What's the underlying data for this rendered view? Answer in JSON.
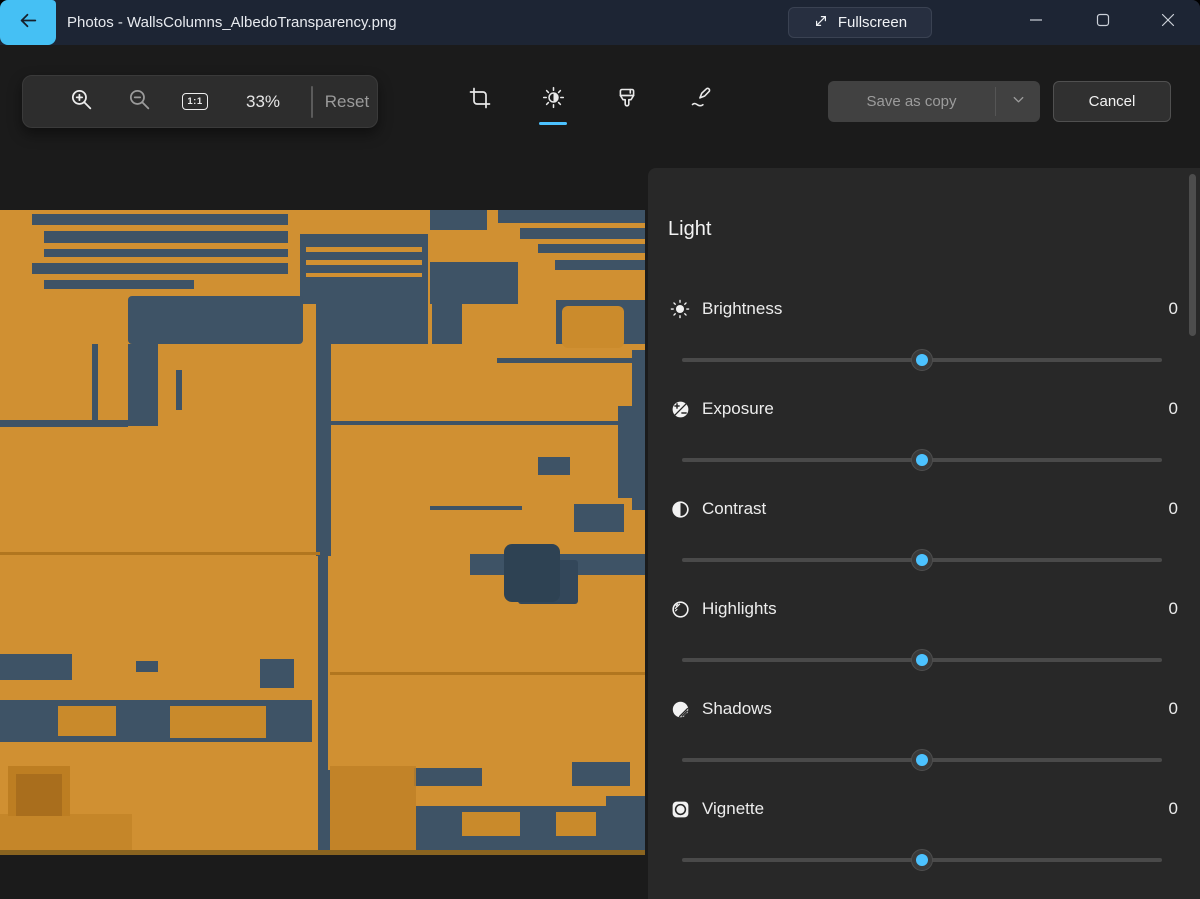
{
  "titlebar": {
    "title": "Photos - WallsColumns_AlbedoTransparency.png",
    "fullscreen_label": "Fullscreen"
  },
  "toolbar": {
    "zoom_level": "33%",
    "actual_size_label": "1:1",
    "reset_label": "Reset",
    "selected_tool": "light-adjustment",
    "save_label": "Save as copy",
    "cancel_label": "Cancel"
  },
  "panel": {
    "heading": "Light",
    "sliders": [
      {
        "label": "Brightness",
        "value": "0",
        "icon": "brightness",
        "position_pct": 50
      },
      {
        "label": "Exposure",
        "value": "0",
        "icon": "exposure",
        "position_pct": 50
      },
      {
        "label": "Contrast",
        "value": "0",
        "icon": "contrast",
        "position_pct": 50
      },
      {
        "label": "Highlights",
        "value": "0",
        "icon": "highlights",
        "position_pct": 50
      },
      {
        "label": "Shadows",
        "value": "0",
        "icon": "shadows",
        "position_pct": 50
      },
      {
        "label": "Vignette",
        "value": "0",
        "icon": "vignette",
        "position_pct": 50
      }
    ]
  },
  "image": {
    "description": "Sci-fi wall albedo texture of orange panels and slate-blue metal slats",
    "palette": {
      "orange": "#d09032",
      "slate": "#3e5366"
    }
  },
  "colors": {
    "accent": "#4cc2ff",
    "titlebar": "#1d2534",
    "panel": "#282828"
  }
}
